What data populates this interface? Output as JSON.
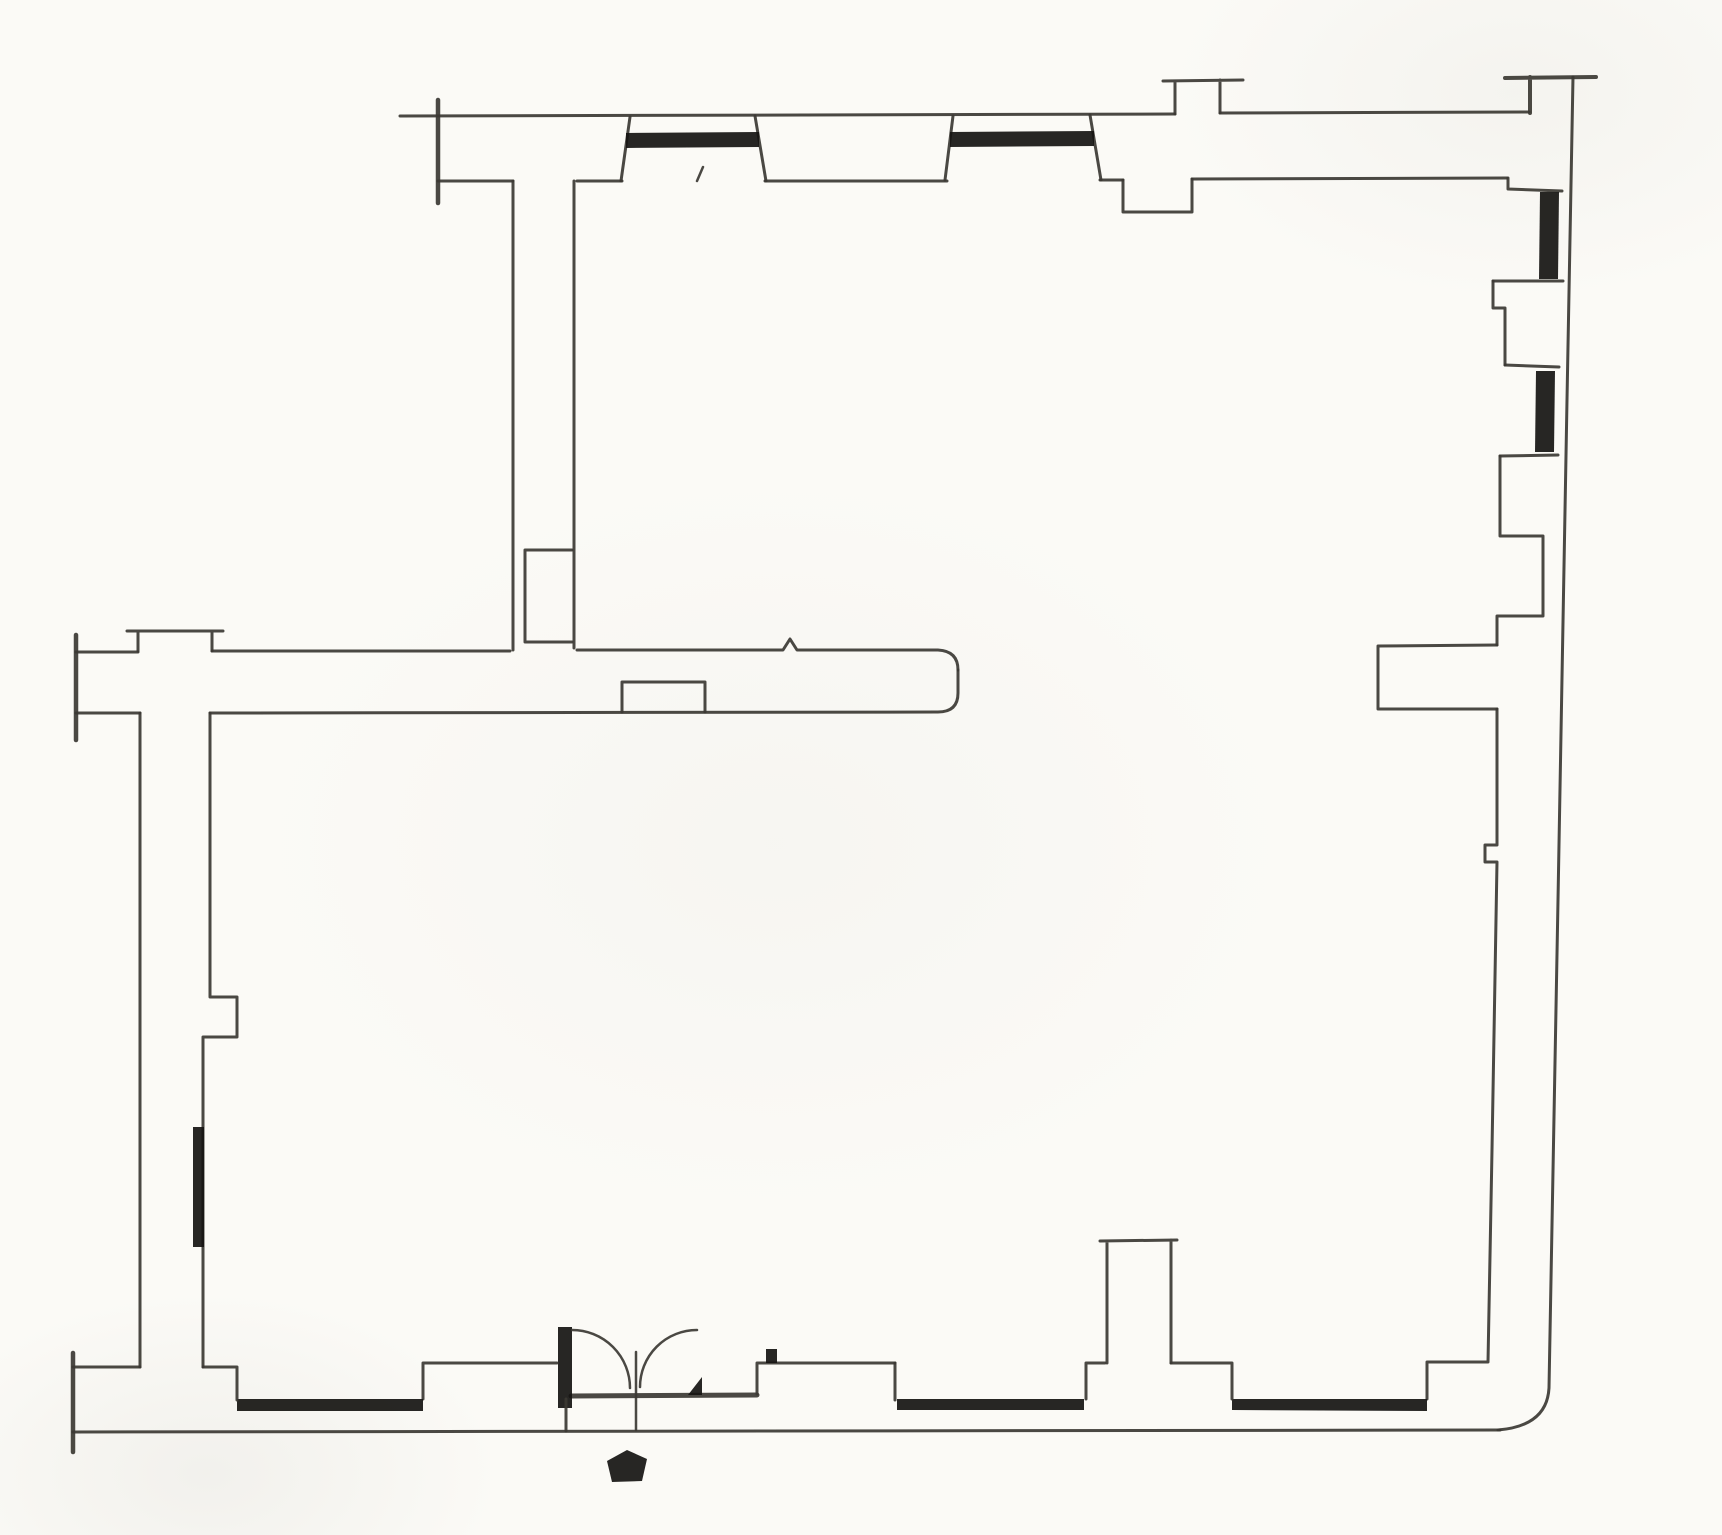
{
  "canvas": {
    "width": 1722,
    "height": 1535,
    "background": "#fbfaf6",
    "ink": "#3b3833",
    "thick": "#151311",
    "default_stroke_width": 3
  },
  "drawing": {
    "kind": "scanned-floor-plan",
    "rooms_visible": 3,
    "window_bar_count": 7,
    "door_leaf_count": 2
  },
  "elements": [
    {
      "name": "top-wall-outer-line",
      "kind": "stroke",
      "w": 3,
      "d": "M400,116 L1175,114 M1220,113 L1529,112"
    },
    {
      "name": "top-wall-inner-line",
      "kind": "stroke",
      "w": 3,
      "d": "M438,181 L513,181 M577,181 L622,181 M765,181 L947,181 M1100,180 L1123,180 M1192,179 L1507,178"
    },
    {
      "name": "top-wall-left-break-cap",
      "kind": "stroke",
      "w": 4.5,
      "d": "M438,100 L438,203"
    },
    {
      "name": "window-north-a-left-jamb",
      "kind": "stroke",
      "w": 3,
      "d": "M630,117 L621,181"
    },
    {
      "name": "window-north-a-right-jamb",
      "kind": "stroke",
      "w": 3,
      "d": "M755,116 L766,181"
    },
    {
      "name": "window-north-a-glazing-bar",
      "kind": "fill",
      "d": "M626,133 L759,132 L759,147 L626,148 Z"
    },
    {
      "name": "window-north-b-left-jamb",
      "kind": "stroke",
      "w": 3,
      "d": "M953,116 L945,180"
    },
    {
      "name": "window-north-b-right-jamb",
      "kind": "stroke",
      "w": 3,
      "d": "M1090,115 L1101,180"
    },
    {
      "name": "window-north-b-glazing-bar",
      "kind": "fill",
      "d": "M950,132 L1094,131 L1094,146 L950,147 Z"
    },
    {
      "name": "north-chimney-breast",
      "kind": "stroke",
      "w": 3,
      "d": "M1163,81 L1243,80 M1175,81 L1175,114 M1220,80 L1220,113"
    },
    {
      "name": "north-wall-niche",
      "kind": "stroke",
      "w": 3,
      "d": "M1123,180 L1123,212 L1192,212 L1192,179"
    },
    {
      "name": "north-door-tick",
      "kind": "stroke",
      "w": 2.5,
      "d": "M697,181 L703,167"
    },
    {
      "name": "northeast-corner-cap",
      "kind": "stroke",
      "w": 4,
      "d": "M1505,78 L1596,77 M1530,77 L1530,113"
    },
    {
      "name": "east-wall-outer-line",
      "kind": "stroke",
      "w": 3,
      "d": "M1573,77 L1567,400 L1558,900 L1549,1388 Q1547,1426 1498,1430"
    },
    {
      "name": "bottom-wall-outer-line",
      "kind": "stroke",
      "w": 3,
      "d": "M73,1432 L1500,1430"
    },
    {
      "name": "window-east-c-head",
      "kind": "stroke",
      "w": 3,
      "d": "M1508,178 L1508,189 L1562,191"
    },
    {
      "name": "window-east-c-glazing-bar",
      "kind": "fill",
      "d": "M1540,192 L1559,192 L1558,279 L1539,279 Z"
    },
    {
      "name": "window-east-c-sill",
      "kind": "stroke",
      "w": 3,
      "d": "M1493,281 L1563,281"
    },
    {
      "name": "east-wall-niche-upper",
      "kind": "stroke",
      "w": 3,
      "d": "M1493,281 L1493,308 L1505,308 L1505,365"
    },
    {
      "name": "window-east-d-head",
      "kind": "stroke",
      "w": 3,
      "d": "M1505,365 L1559,367"
    },
    {
      "name": "window-east-d-glazing-bar",
      "kind": "fill",
      "d": "M1536,371 L1555,371 L1554,452 L1535,452 Z"
    },
    {
      "name": "window-east-d-sill",
      "kind": "stroke",
      "w": 3,
      "d": "M1500,456 L1558,455"
    },
    {
      "name": "east-wall-inner-line-mid",
      "kind": "stroke",
      "w": 3,
      "d": "M1500,456 L1500,536 L1543,536 L1543,616 L1497,616 L1497,645"
    },
    {
      "name": "east-partition-stub",
      "kind": "stroke",
      "w": 3,
      "d": "M1497,645 L1378,646 L1378,709 L1497,709"
    },
    {
      "name": "east-wall-inner-line-lower",
      "kind": "stroke",
      "w": 3,
      "d": "M1497,709 L1497,845 L1485,845 L1485,862 L1497,862 L1492,1150 L1488,1362 L1427,1362 L1427,1399"
    },
    {
      "name": "window-south-g-glazing-bar",
      "kind": "fill",
      "d": "M1232,1399 L1427,1399 L1427,1411 L1232,1410 Z"
    },
    {
      "name": "south-wall-inner-right",
      "kind": "stroke",
      "w": 3,
      "d": "M1171,1363 L1232,1363 L1232,1399"
    },
    {
      "name": "oven-pier",
      "kind": "stroke",
      "w": 3,
      "d": "M1100,1241 L1177,1240 M1107,1241 L1107,1363 M1171,1240 L1171,1363"
    },
    {
      "name": "south-wall-inner-mid",
      "kind": "stroke",
      "w": 3,
      "d": "M1086,1399 L1086,1363 L1105,1363"
    },
    {
      "name": "window-south-f-glazing-bar",
      "kind": "fill",
      "d": "M897,1399 L1084,1399 L1084,1410 L897,1410 Z"
    },
    {
      "name": "south-wall-inner-f-left",
      "kind": "stroke",
      "w": 3,
      "d": "M895,1363 L895,1400"
    },
    {
      "name": "south-wall-inner-door-right",
      "kind": "stroke",
      "w": 3,
      "d": "M757,1394 L757,1363 L895,1363"
    },
    {
      "name": "entry-marker-tick",
      "kind": "fill",
      "d": "M766,1349 L777,1349 L777,1363 L766,1363 Z"
    },
    {
      "name": "entry-door-threshold",
      "kind": "stroke",
      "w": 5,
      "d": "M571,1396 L757,1395"
    },
    {
      "name": "entry-door-left-jamb",
      "kind": "fill",
      "d": "M558,1327 L572,1327 L572,1408 L558,1408 Z"
    },
    {
      "name": "entry-door-left-leaf-arc",
      "kind": "stroke",
      "w": 2.5,
      "d": "M572,1330 A58,58 0 0 1 630,1388"
    },
    {
      "name": "entry-door-right-leaf-arc",
      "kind": "stroke",
      "w": 2.5,
      "d": "M697,1330 A57,57 0 0 0 640,1387"
    },
    {
      "name": "entry-door-meeting-line",
      "kind": "stroke",
      "w": 2.5,
      "d": "M636,1352 L636,1430"
    },
    {
      "name": "entry-door-right-leaf-foot",
      "kind": "fill",
      "d": "M688,1395 L702,1377 L702,1395 Z"
    },
    {
      "name": "entry-door-sill-line",
      "kind": "stroke",
      "w": 3,
      "d": "M566,1399 L566,1431"
    },
    {
      "name": "south-wall-inner-e-right",
      "kind": "stroke",
      "w": 3,
      "d": "M423,1399 L423,1363 L557,1363"
    },
    {
      "name": "window-south-e-glazing-bar",
      "kind": "fill",
      "d": "M237,1399 L423,1399 L423,1411 L237,1411 Z"
    },
    {
      "name": "south-wall-inner-left",
      "kind": "stroke",
      "w": 3,
      "d": "M203,1367 L237,1367 L237,1400"
    },
    {
      "name": "south-wall-inner-stub-left",
      "kind": "stroke",
      "w": 3,
      "d": "M73,1367 L140,1367"
    },
    {
      "name": "southwest-break-cap",
      "kind": "stroke",
      "w": 4.5,
      "d": "M73,1353 L73,1452"
    },
    {
      "name": "west-wall-outer-line",
      "kind": "stroke",
      "w": 3,
      "d": "M140,713 L140,1367"
    },
    {
      "name": "west-wall-inner-line",
      "kind": "stroke",
      "w": 3,
      "d": "M210,713 L210,997 L237,997 L237,1037 L203,1037 L203,1367"
    },
    {
      "name": "west-wall-door-bar",
      "kind": "fill",
      "d": "M193,1127 L204,1127 L204,1247 L193,1247 Z"
    },
    {
      "name": "middle-wall-top-line",
      "kind": "stroke",
      "w": 3,
      "d": "M76,652 L138,652 M212,651 L510,651 M577,650 L783,650 L790,639 L797,650 L938,650 Q958,651 958,670"
    },
    {
      "name": "middle-wall-end-and-bottom-line",
      "kind": "stroke",
      "w": 3,
      "d": "M958,670 L958,693 Q958,712 938,712 L210,713"
    },
    {
      "name": "middle-wall-bottom-stub",
      "kind": "stroke",
      "w": 3,
      "d": "M76,713 L140,713"
    },
    {
      "name": "west-chimney-breast",
      "kind": "stroke",
      "w": 3,
      "d": "M127,631 L223,631 M138,631 L138,651 M212,631 L212,651"
    },
    {
      "name": "middle-wall-break-cap",
      "kind": "stroke",
      "w": 4.5,
      "d": "M76,635 L76,740"
    },
    {
      "name": "middle-wall-niche",
      "kind": "stroke",
      "w": 3,
      "d": "M622,712 L622,682 L705,682 L705,712"
    },
    {
      "name": "partition-wall-left-line",
      "kind": "stroke",
      "w": 3,
      "d": "M513,181 L513,650"
    },
    {
      "name": "partition-wall-right-line",
      "kind": "stroke",
      "w": 3,
      "d": "M574,181 L574,648"
    },
    {
      "name": "partition-wall-niche",
      "kind": "stroke",
      "w": 3,
      "d": "M525,642 L525,550 L572,550 M525,642 L572,642"
    },
    {
      "name": "entry-pentagon-marker",
      "kind": "fill",
      "d": "M607,1461 L627,1450 L647,1459 L642,1481 L612,1482 Z"
    }
  ]
}
